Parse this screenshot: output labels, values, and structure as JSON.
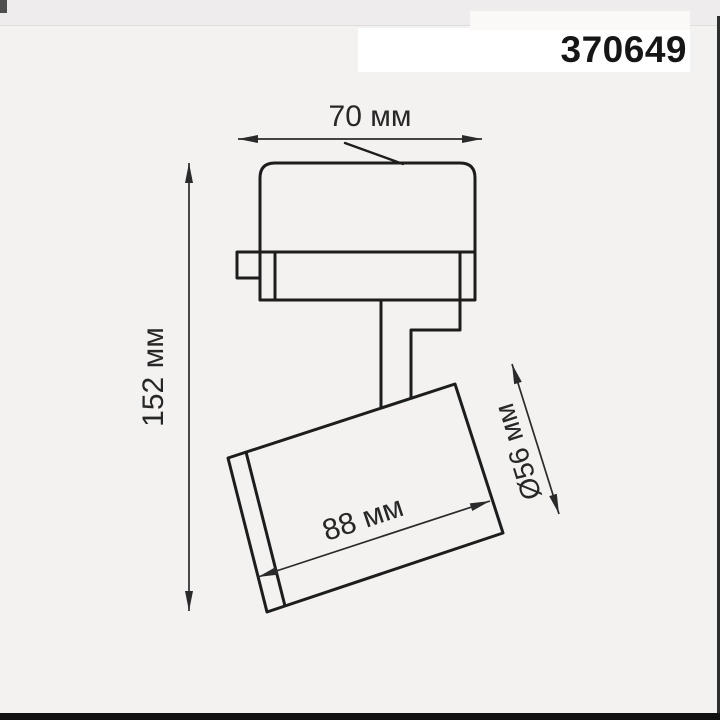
{
  "product": {
    "code": "370649"
  },
  "diagram": {
    "type": "technical-dimension-drawing",
    "subject": "track-mounted spotlight side view",
    "labels": {
      "top_width": "70 мм",
      "total_height": "152 мм",
      "head_length": "88 мм",
      "head_diameter": "Ø56 мм"
    },
    "parts": [
      "track-adapter-body",
      "adapter-lock-lever",
      "track-contact-tab",
      "swivel-stem",
      "spotlight-head"
    ]
  },
  "colors": {
    "background": "#f3f2f1",
    "line": "#1d1d1d",
    "dimension_line": "#2a2a2a",
    "code_band": "#ffffff",
    "code_text": "#161616",
    "frame_right": "#2e2e2e",
    "frame_bottom": "#111111"
  }
}
